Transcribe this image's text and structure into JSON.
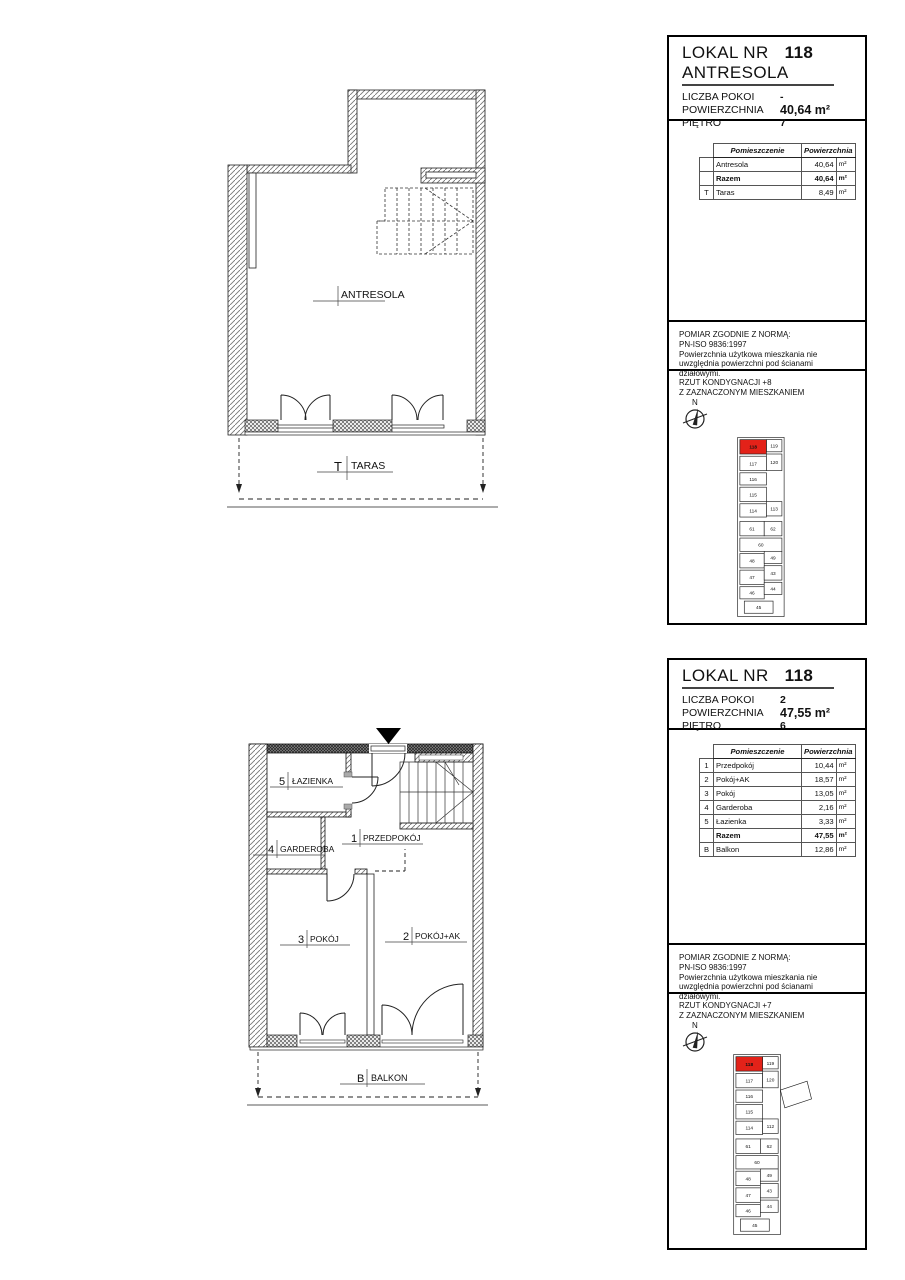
{
  "colors": {
    "highlight": "#e32219"
  },
  "plan_top": {
    "room": "ANTRESOLA",
    "terrace_prefix": "T",
    "terrace": "TARAS"
  },
  "plan_bottom": {
    "rooms": {
      "bath_num": "5",
      "bath": "ŁAZIENKA",
      "hall_num": "1",
      "hall": "PRZEDPOKÓJ",
      "ward_num": "4",
      "ward": "GARDEROBA",
      "room3_num": "3",
      "room3": "POKÓJ",
      "room2_num": "2",
      "room2": "POKÓJ+AK",
      "balc_num": "B",
      "balc": "BALKON"
    }
  },
  "panel1": {
    "title": "LOKAL NR",
    "number": "118",
    "subtitle": "ANTRESOLA",
    "fields": [
      {
        "label": "LICZBA POKOI",
        "value": "-"
      },
      {
        "label": "POWIERZCHNIA",
        "value": "40,64 m²"
      },
      {
        "label": "PIĘTRO",
        "value": "7"
      }
    ],
    "table": {
      "col_room": "Pomieszczenie",
      "col_area": "Powierzchnia",
      "rows": [
        {
          "idx": "",
          "name": "Antresola",
          "value": "40,64",
          "unit": "m²"
        },
        {
          "idx": "",
          "name": "Razem",
          "value": "40,64",
          "unit": "m²"
        },
        {
          "idx": "T",
          "name": "Taras",
          "value": "8,49",
          "unit": "m²"
        }
      ]
    },
    "note": [
      "POMIAR ZGODNIE Z NORMĄ:",
      "PN-ISO 9836:1997",
      "Powierzchnia użytkowa mieszkania nie",
      "uwzględnia powierzchni pod ścianami działowymi."
    ],
    "rzut": [
      "RZUT KONDYGNACJI +8",
      "Z ZAZNACZONYM MIESZKANIEM"
    ],
    "compass_n": "N",
    "map": {
      "units": {
        "u118": "118",
        "u119": "119",
        "u117": "117",
        "u120": "120",
        "u116": "116",
        "u115": "115",
        "u114": "114",
        "u113": "113",
        "u61": "61",
        "u62": "62",
        "u60": "60",
        "u48": "48",
        "u49": "49",
        "u47": "47",
        "u43": "43",
        "u46": "46",
        "u44": "44",
        "u45": "45"
      }
    }
  },
  "panel2": {
    "title": "LOKAL NR",
    "number": "118",
    "fields": [
      {
        "label": "LICZBA POKOI",
        "value": "2"
      },
      {
        "label": "POWIERZCHNIA",
        "value": "47,55 m²"
      },
      {
        "label": "PIĘTRO",
        "value": "6"
      }
    ],
    "table": {
      "col_room": "Pomieszczenie",
      "col_area": "Powierzchnia",
      "rows": [
        {
          "idx": "1",
          "name": "Przedpokój",
          "value": "10,44",
          "unit": "m²"
        },
        {
          "idx": "2",
          "name": "Pokój+AK",
          "value": "18,57",
          "unit": "m²"
        },
        {
          "idx": "3",
          "name": "Pokój",
          "value": "13,05",
          "unit": "m²"
        },
        {
          "idx": "4",
          "name": "Garderoba",
          "value": "2,16",
          "unit": "m²"
        },
        {
          "idx": "5",
          "name": "Łazienka",
          "value": "3,33",
          "unit": "m²"
        },
        {
          "idx": "",
          "name": "Razem",
          "value": "47,55",
          "unit": "m²"
        },
        {
          "idx": "B",
          "name": "Balkon",
          "value": "12,86",
          "unit": "m²"
        }
      ]
    },
    "note": [
      "POMIAR ZGODNIE Z NORMĄ:",
      "PN-ISO 9836:1997",
      "Powierzchnia użytkowa mieszkania nie",
      "uwzględnia powierzchni pod ścianami działowymi."
    ],
    "rzut": [
      "RZUT KONDYGNACJI +7",
      "Z ZAZNACZONYM MIESZKANIEM"
    ],
    "compass_n": "N",
    "map": {
      "units": {
        "u118": "118",
        "u119": "119",
        "u117": "117",
        "u120": "120",
        "u116": "116",
        "u115": "115",
        "u114": "114",
        "u113": "112",
        "u61": "61",
        "u62": "62",
        "u60": "60",
        "u48": "48",
        "u49": "49",
        "u47": "47",
        "u43": "43",
        "u46": "46",
        "u44": "44",
        "u45": "45"
      }
    }
  }
}
